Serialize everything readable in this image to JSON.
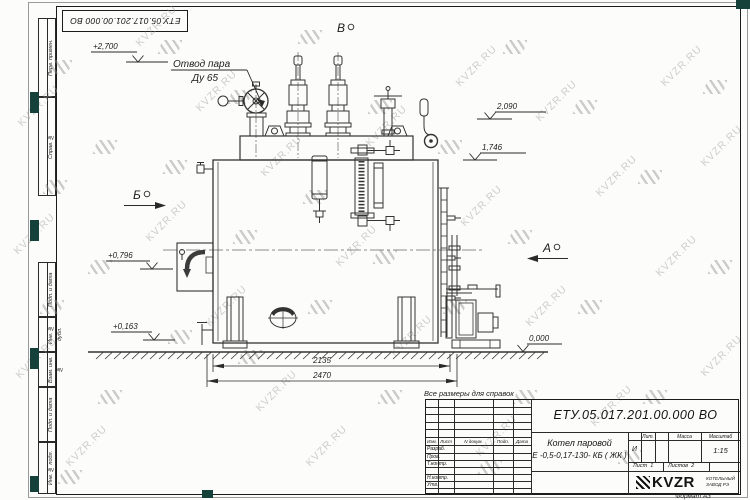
{
  "watermark": {
    "text": "KVZR.RU"
  },
  "sheet": {
    "stamp_number": "ЕТУ.05.017.201.00.000  ВО",
    "format_note": "Формат А3",
    "margin_columns": [
      "Перв. примен.",
      "Справ. №",
      "Подп. и дата",
      "Инв. № дубл.",
      "Взам. инв. №",
      "Подп. и дата",
      "Инв. № подл."
    ]
  },
  "drawing": {
    "note": "Все размеры для справок",
    "callout": {
      "line1": "Отвод пара",
      "line2": "Ду 65"
    },
    "views": {
      "top": "В",
      "left": "Б",
      "right": "А"
    },
    "elevations": {
      "e2700": "+2,700",
      "e2090": "2,090",
      "e1746": "1,746",
      "e0796": "+0,796",
      "e0163": "+0,163",
      "e0000": "0,000"
    },
    "dimensions": {
      "inner": "2135",
      "outer": "2470"
    }
  },
  "title_block": {
    "doc_number": "ЕТУ.05.017.201.00.000  ВО",
    "product": {
      "line1": "Котел паровой",
      "line2": "Е -0,5-0,17-130- КБ ( ЖК )"
    },
    "columns": {
      "izm": "Изм.",
      "list": "Лист",
      "doc": "N докум.",
      "sign": "Подп.",
      "date": "Дата"
    },
    "rows": {
      "r1": "Разраб.",
      "r2": "Пров.",
      "r3": "Т.контр.",
      "r4": "Н.контр.",
      "r5": "Утв."
    },
    "lit": {
      "label": "Лит.",
      "value": "И"
    },
    "mass": {
      "label": "Масса"
    },
    "scale": {
      "label": "Масштаб",
      "value": "1:15"
    },
    "sheet": {
      "label": "Лист",
      "value": "1"
    },
    "sheets": {
      "label": "Листов",
      "value": "2"
    },
    "company": {
      "name": "KVZR",
      "sub1": "КОТЕЛЬНЫЙ",
      "sub2": "ЗАВОД РЭ"
    }
  }
}
